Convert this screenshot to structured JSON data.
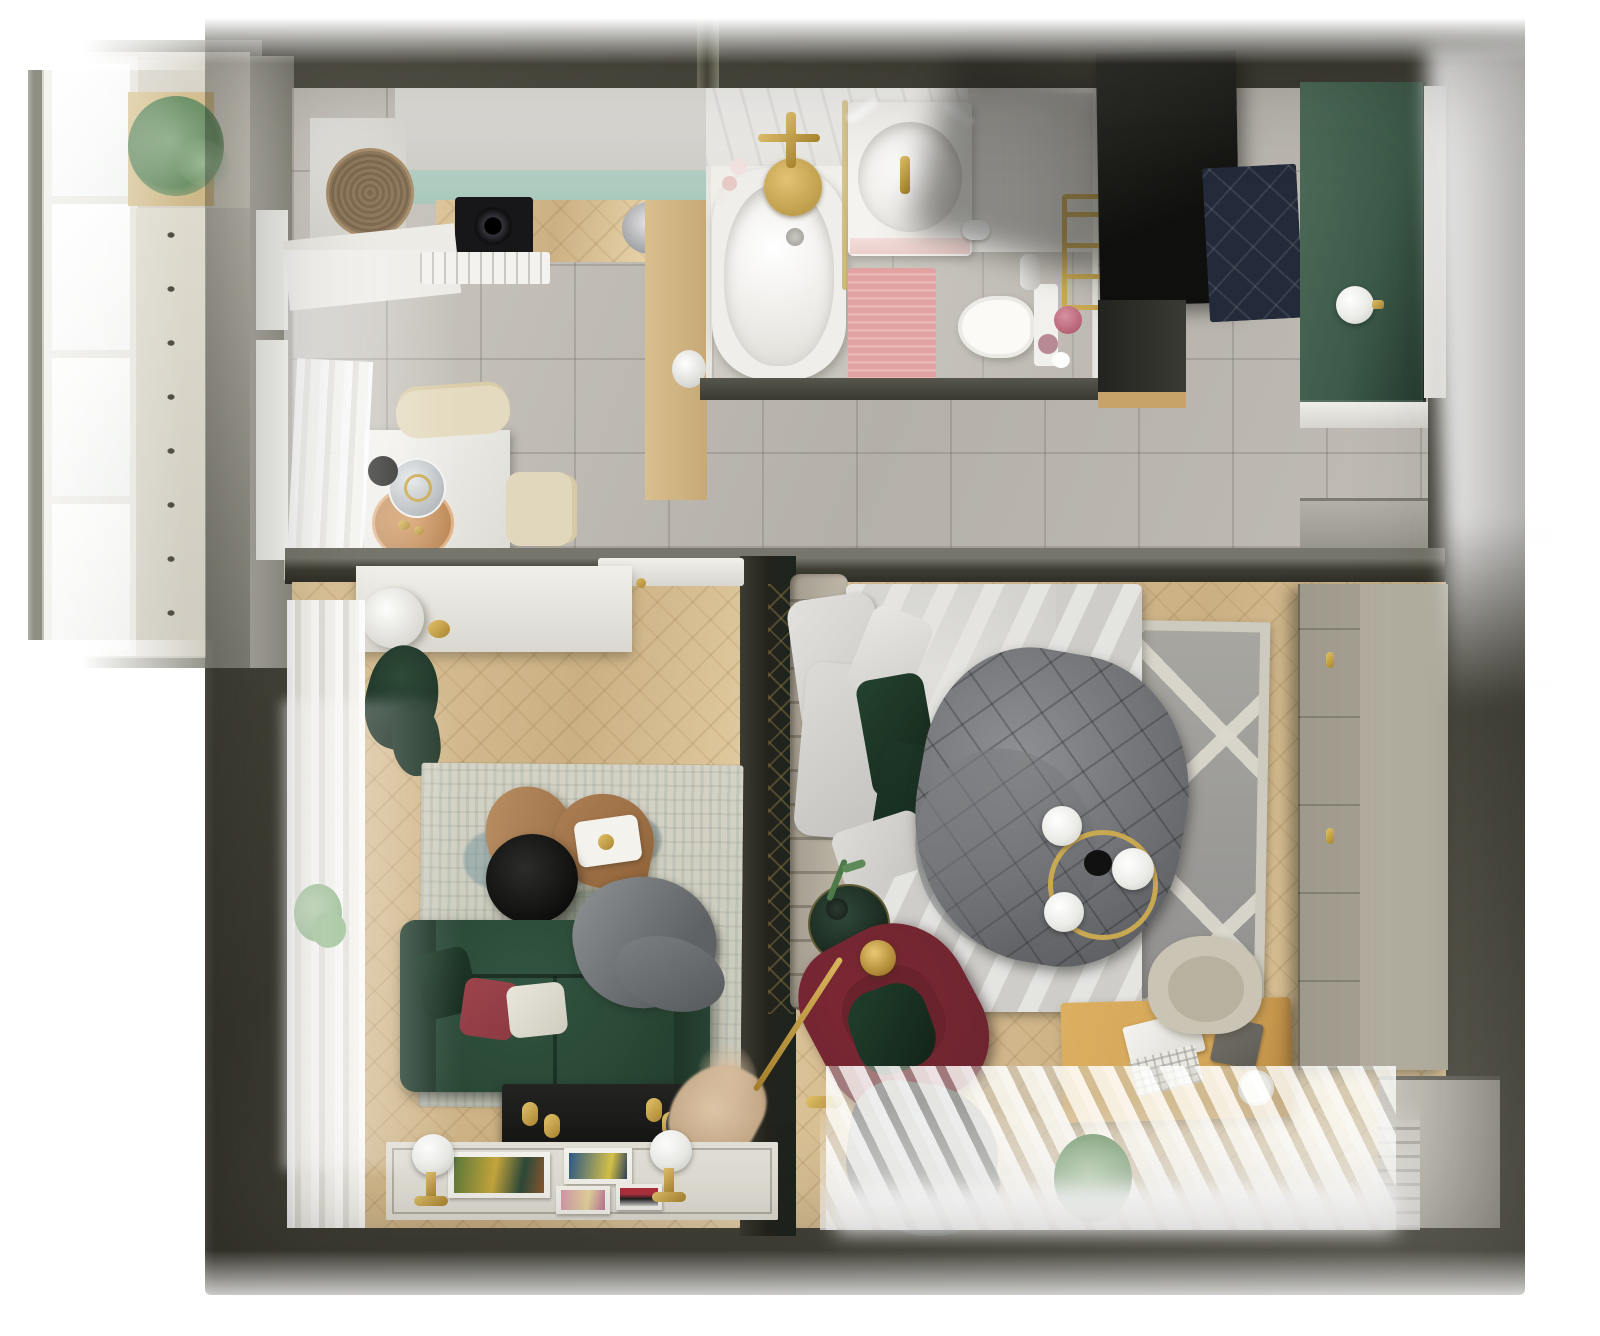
{
  "meta": {
    "title": "Top-down 3D render of a one-bedroom apartment floor plan",
    "view": "bird's-eye interior render",
    "width_px": 1600,
    "height_px": 1336
  },
  "palette": {
    "wall": "#403f35",
    "wallLight": "#6b6a5f",
    "tileA": "#cdc9c2",
    "tileB": "#b4b0a9",
    "woodA": "#ddc59b",
    "woodB": "#cbb083",
    "teal": "#a9c8bc",
    "greenWall": "#3c5a49",
    "sofa": "#2a4836",
    "pillowRed": "#8d3a42",
    "armchair": "#6f2530",
    "gold": "#c9a852",
    "duvet": "#6e7074",
    "rugGray": "#a5a49e",
    "rugCream": "#cdcabf",
    "pink": "#e2a2a2",
    "mat": "#232b3a",
    "black": "#161615",
    "greige": "#aaa595",
    "oak": "#d2a458",
    "curtain": "#f4f4f0",
    "marble": "#f3f1ec"
  },
  "rooms": {
    "balcony": {
      "label": "Balcony",
      "items": {
        "window": "Tall white balcony windows",
        "plant": "Hanging eucalyptus plant on wooden shelf",
        "floor": "Light tile floor with dark diamond accents",
        "wall": "Balcony side wall"
      }
    },
    "kitchen": {
      "label": "Kitchen & dining area",
      "items": {
        "cabinets": "White upper cabinet run",
        "tealFront": "Teal cabinet fronts",
        "counter": "Oak worktop",
        "hob": "Black built-in hob",
        "pan": "Stainless pan on worktop",
        "washer": "White appliance with wicker basket on top",
        "basket": "Wicker basket",
        "dishwasher": "Integrated dishwasher front",
        "sideCounter": "Oak side counter",
        "kettle": "White kettle",
        "table": "White square dining table",
        "chairA": "Beige dining chair (top)",
        "chairB": "Beige dining chair (right)",
        "tray": "Copper serving tray",
        "carafe": "Glass carafe",
        "bowl": "Small black bowl",
        "curtain": "Sheer window curtain",
        "floor": "Gray ceramic tile floor"
      }
    },
    "bathroom": {
      "label": "Bathroom",
      "items": {
        "tub": "White bathtub with brass shower set",
        "shower": "Brass rain shower plate",
        "faucet": "Brass cross faucet",
        "candles": "Candles beside the tub",
        "screen": "Glass shower screen with brass trim",
        "vanity": "Vanity unit with basin and brass tap",
        "mirrorLight": "Mirror light reflections",
        "toilet": "Wall-faced toilet",
        "paper": "Toilet paper holder",
        "spray": "Toilet brush holder",
        "rug": "Pink bath rug",
        "ladder": "Brass towel ladder",
        "cosmetics": "Pink glass jars"
      }
    },
    "hallway": {
      "label": "Entry hallway",
      "items": {
        "wardrobe": "Tall black wardrobe",
        "matQ": "Navy quilted doormat",
        "greenWall": "Green paneled accent wall",
        "sconce": "White globe sconce",
        "doorFrame": "Entrance door frame",
        "shoeCabinet": "Gray shoe cabinet",
        "floor": "Gray ceramic tile floor"
      }
    },
    "living": {
      "label": "Living room",
      "items": {
        "sideboard": "White sideboard",
        "lamp": "Round table lamp",
        "goldBox": "Small brass box",
        "garment": "Green garment on rail",
        "curtain": "Sheer curtains along window wall",
        "plant": "Monstera plant",
        "rug": "Distressed beige-blue area rug",
        "leafA": "Leaf-shaped coffee table (upper)",
        "leafB": "Leaf-shaped coffee table (lower)",
        "blackTable": "Round black coffee table",
        "trayCard": "White tray with cards",
        "sofa": "Dark green velvet sofa",
        "cushionGreen": "Green cushion",
        "cushionRed": "Terracotta-red cushion",
        "cushionWhite": "Off-white cushion",
        "throw": "Gray knit throw",
        "console": "Black media console with brass knobs",
        "vase": "Dark vase with pampas grass",
        "mat": "White display mat",
        "printA": "Art print (large, botanical)",
        "printB": "Art print (blue)",
        "printC": "Art print (pink)",
        "printD": "Art print (red stripes)",
        "sconceA": "Globe floor lamp (left)",
        "sconceB": "Globe floor lamp (right)",
        "door": "Open white door leaf",
        "floor": "Herringbone oak floor"
      }
    },
    "bedroom": {
      "label": "Bedroom & workspace",
      "items": {
        "headboard": "Channel-tufted headboard",
        "bed": "Double bed with light sheets",
        "pillowA": "White pillow",
        "pillowB": "White pillow",
        "pillowC": "Small white pillow",
        "pillowD": "White pillow (foot)",
        "greenPillowA": "Forest-green pillow",
        "greenPillowB": "Forest-green pillow",
        "duvet": "Gray quilted duvet",
        "chandelier": "Brass ring chandelier with milk globes",
        "sideTable": "Green round side table",
        "decanter": "Glass decanter",
        "sprig": "Plant sprig",
        "armchair": "Burgundy tufted armchair",
        "chairCushion": "Green cushion on armchair",
        "floorLamp": "Brass floor lamp",
        "plaid": "Gray plaid dropped on floor",
        "rug": "Gray rug with cream trellis pattern",
        "desk": "Oak writing desk",
        "laptop": "Open laptop",
        "notebook": "Gray notebook",
        "mug": "White mug",
        "chair": "Beige desk chair",
        "wardrobe": "Greige paneled wardrobe with brass knobs",
        "cabinet": "White storage cabinet by the window",
        "curtain": "Sheer curtains on window wall",
        "plantSill": "Plant on the windowsill",
        "divider": "Dark partition wall with brass trellis inlay",
        "floor": "Herringbone oak floor"
      }
    }
  },
  "structure": {
    "outerWalls": "Olive-gray exterior walls",
    "midWall": "Wall between day zone and rooms",
    "pipe": "Vertical service pipe at top wall",
    "entryLight": "Overexposed daylight at entrance (top right)",
    "bathWall": "Bathroom partition wall"
  }
}
